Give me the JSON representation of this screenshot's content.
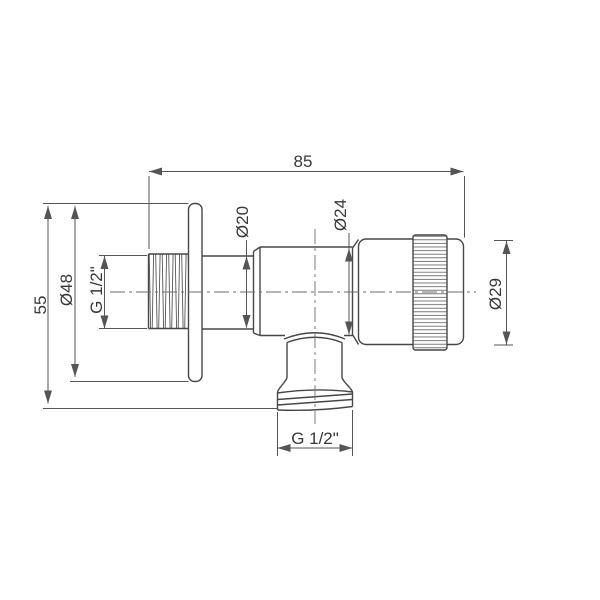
{
  "drawing": {
    "labels": {
      "overall_length": "85",
      "overall_height": "55",
      "flange_diameter": "Ø48",
      "inlet_thread": "G 1/2\"",
      "pipe_diameter": "Ø20",
      "body_diameter": "Ø24",
      "handle_diameter": "Ø29",
      "outlet_thread": "G 1/2\""
    },
    "colors": {
      "line": "#474747",
      "dimension": "#555555",
      "text": "#383838",
      "background": "#ffffff"
    }
  }
}
